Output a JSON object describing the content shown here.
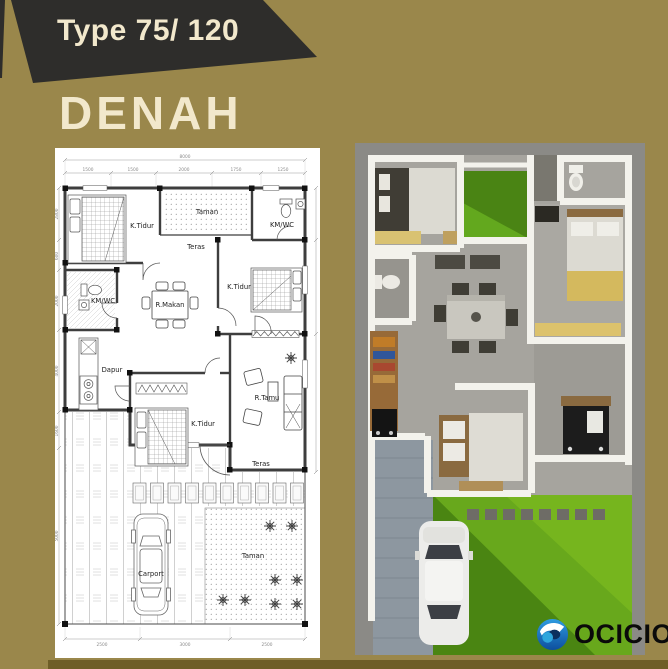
{
  "badge": {
    "label": "Type 75/ 120"
  },
  "title": "DENAH",
  "brand": {
    "name": "OCICIO"
  },
  "colors": {
    "background": "#9a874b",
    "badge_bg": "#2e2d2b",
    "cream_text": "#f2e8cc",
    "bottom_bar": "#6e5e27",
    "logo_blue": "#1d7cc9",
    "grass_green": "#55961c",
    "render_bg": "#8b8a86"
  },
  "floor_plan": {
    "rooms": [
      {
        "label": "K.Tidur"
      },
      {
        "label": "Taman"
      },
      {
        "label": "KM/WC"
      },
      {
        "label": "Teras"
      },
      {
        "label": "K.Tidur"
      },
      {
        "label": "KM/WC"
      },
      {
        "label": "R.Makan"
      },
      {
        "label": "Dapur"
      },
      {
        "label": "K.Tidur"
      },
      {
        "label": "R.Tamu"
      },
      {
        "label": "Teras"
      },
      {
        "label": "Carport"
      },
      {
        "label": "Taman"
      }
    ],
    "dimensions": {
      "top_total": "8000",
      "top_segments": [
        "1500",
        "1500",
        "2000",
        "1750",
        "1250"
      ],
      "left_segments": [
        "2800",
        "600",
        "2000",
        "4000",
        "1600",
        "5000"
      ],
      "bottom_segments": [
        "2500",
        "3000",
        "2500"
      ]
    }
  }
}
